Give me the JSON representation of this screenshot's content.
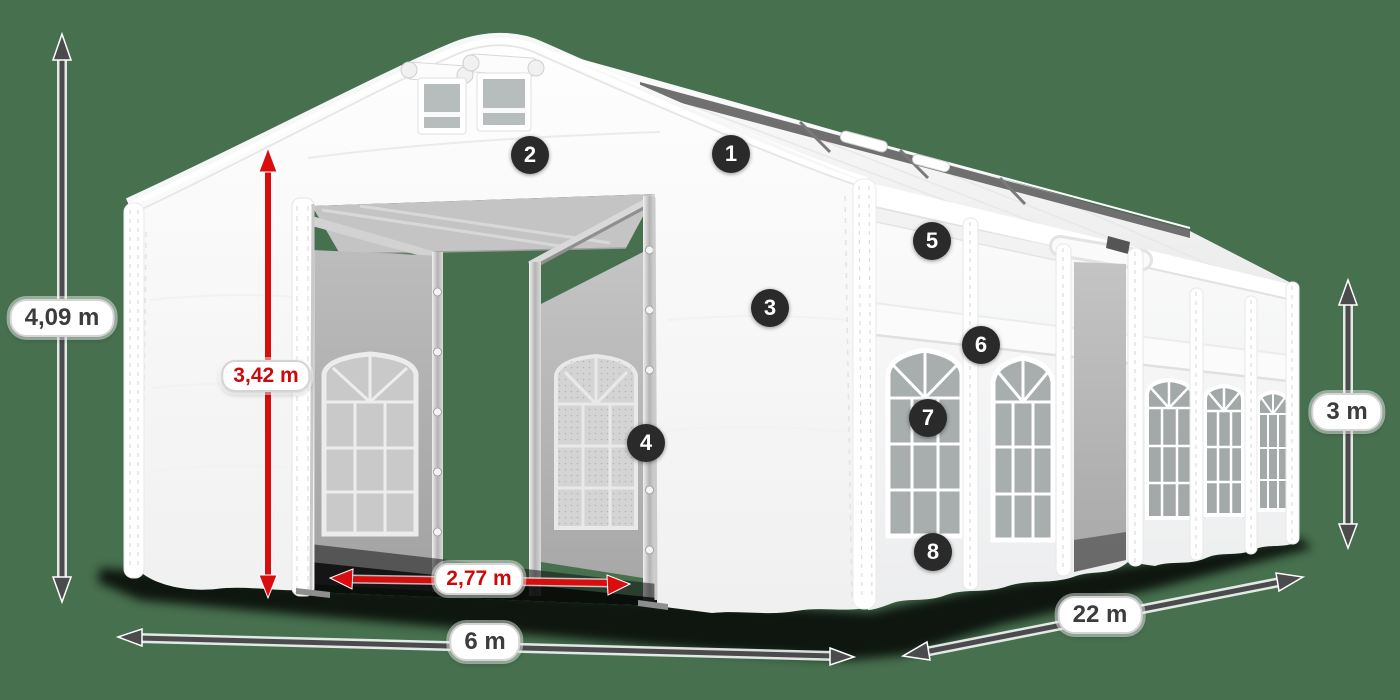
{
  "colors": {
    "background": "#47704F",
    "tent_white": "#FFFFFF",
    "interior_gray": "#B3B3B3",
    "window_glass_gray": "#A8AEAE",
    "arrow_dark": "#4B4B4D",
    "arrow_red": "#D90D0D",
    "label_text_dark": "#3C3C3E",
    "label_text_red": "#C90B0B",
    "badge_background": "#2A2A2A",
    "badge_text": "#FFFFFF"
  },
  "dimension_labels": {
    "total_height": "4,09 m",
    "entrance_height": "3,42 m",
    "entrance_width": "2,77 m",
    "width": "6 m",
    "length": "22 m",
    "side_height": "3 m"
  },
  "markers": [
    {
      "number": "1"
    },
    {
      "number": "2"
    },
    {
      "number": "3"
    },
    {
      "number": "4"
    },
    {
      "number": "5"
    },
    {
      "number": "6"
    },
    {
      "number": "7"
    },
    {
      "number": "8"
    }
  ]
}
